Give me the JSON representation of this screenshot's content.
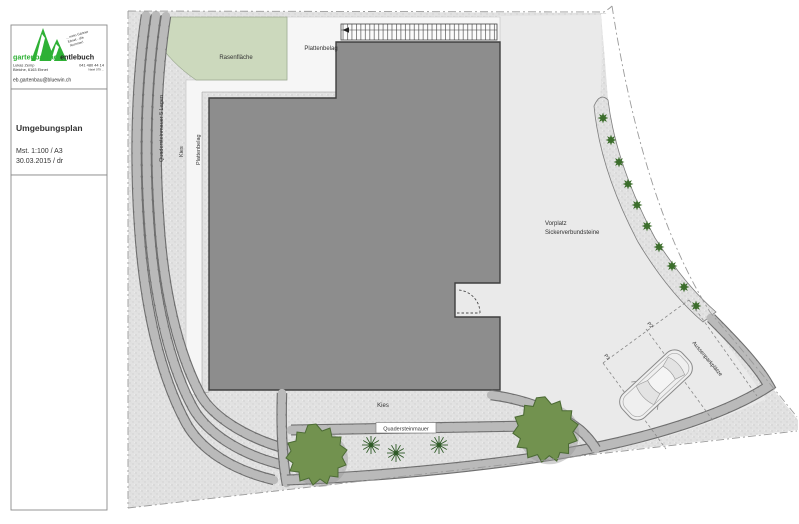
{
  "sidebar": {
    "logo": {
      "brand_green": "gartenbau ag",
      "brand_dark": " entlebuch",
      "slogan_lines": [
        "... mein Gärtner",
        "Ebnet - die",
        "Nummer!"
      ],
      "contact_name": "Lukas Zemp",
      "contact_address": "Bleiche, 6163 Ebnet",
      "phone": "041 480 44 14",
      "phone2": "Natel 079 ...",
      "email": "eb.gartenbau@bluewin.ch"
    },
    "title_block": {
      "title": "Umgebungsplan",
      "scale": "Mst. 1:100 / A3",
      "date": "30.03.2015 / dr"
    }
  },
  "plan": {
    "labels": {
      "lawn": "Rasenfläche",
      "paving_top": "Plattenbelag",
      "wall_left": "Quadersteinmauer 5 Lagen",
      "gravel_left": "Kies",
      "paving_left": "Plattenbelag",
      "forecourt_line1": "Vorplatz",
      "forecourt_line2": "Sickerverbundsteine",
      "gravel_bottom": "Kies",
      "wall_bottom": "Quadersteinmauer",
      "parking": "Aussenparkplätze",
      "stall1": "P1",
      "stall2": "P2"
    },
    "colors": {
      "brand_green": "#2eb135",
      "lawn": "#ccd9bd",
      "building": "#8d8d8d",
      "forecourt": "#eaeaea",
      "paving": "#f6f6f6",
      "shrub": "#72924f",
      "tree": "#3c6e2c",
      "wall_block": "#bababa"
    }
  }
}
